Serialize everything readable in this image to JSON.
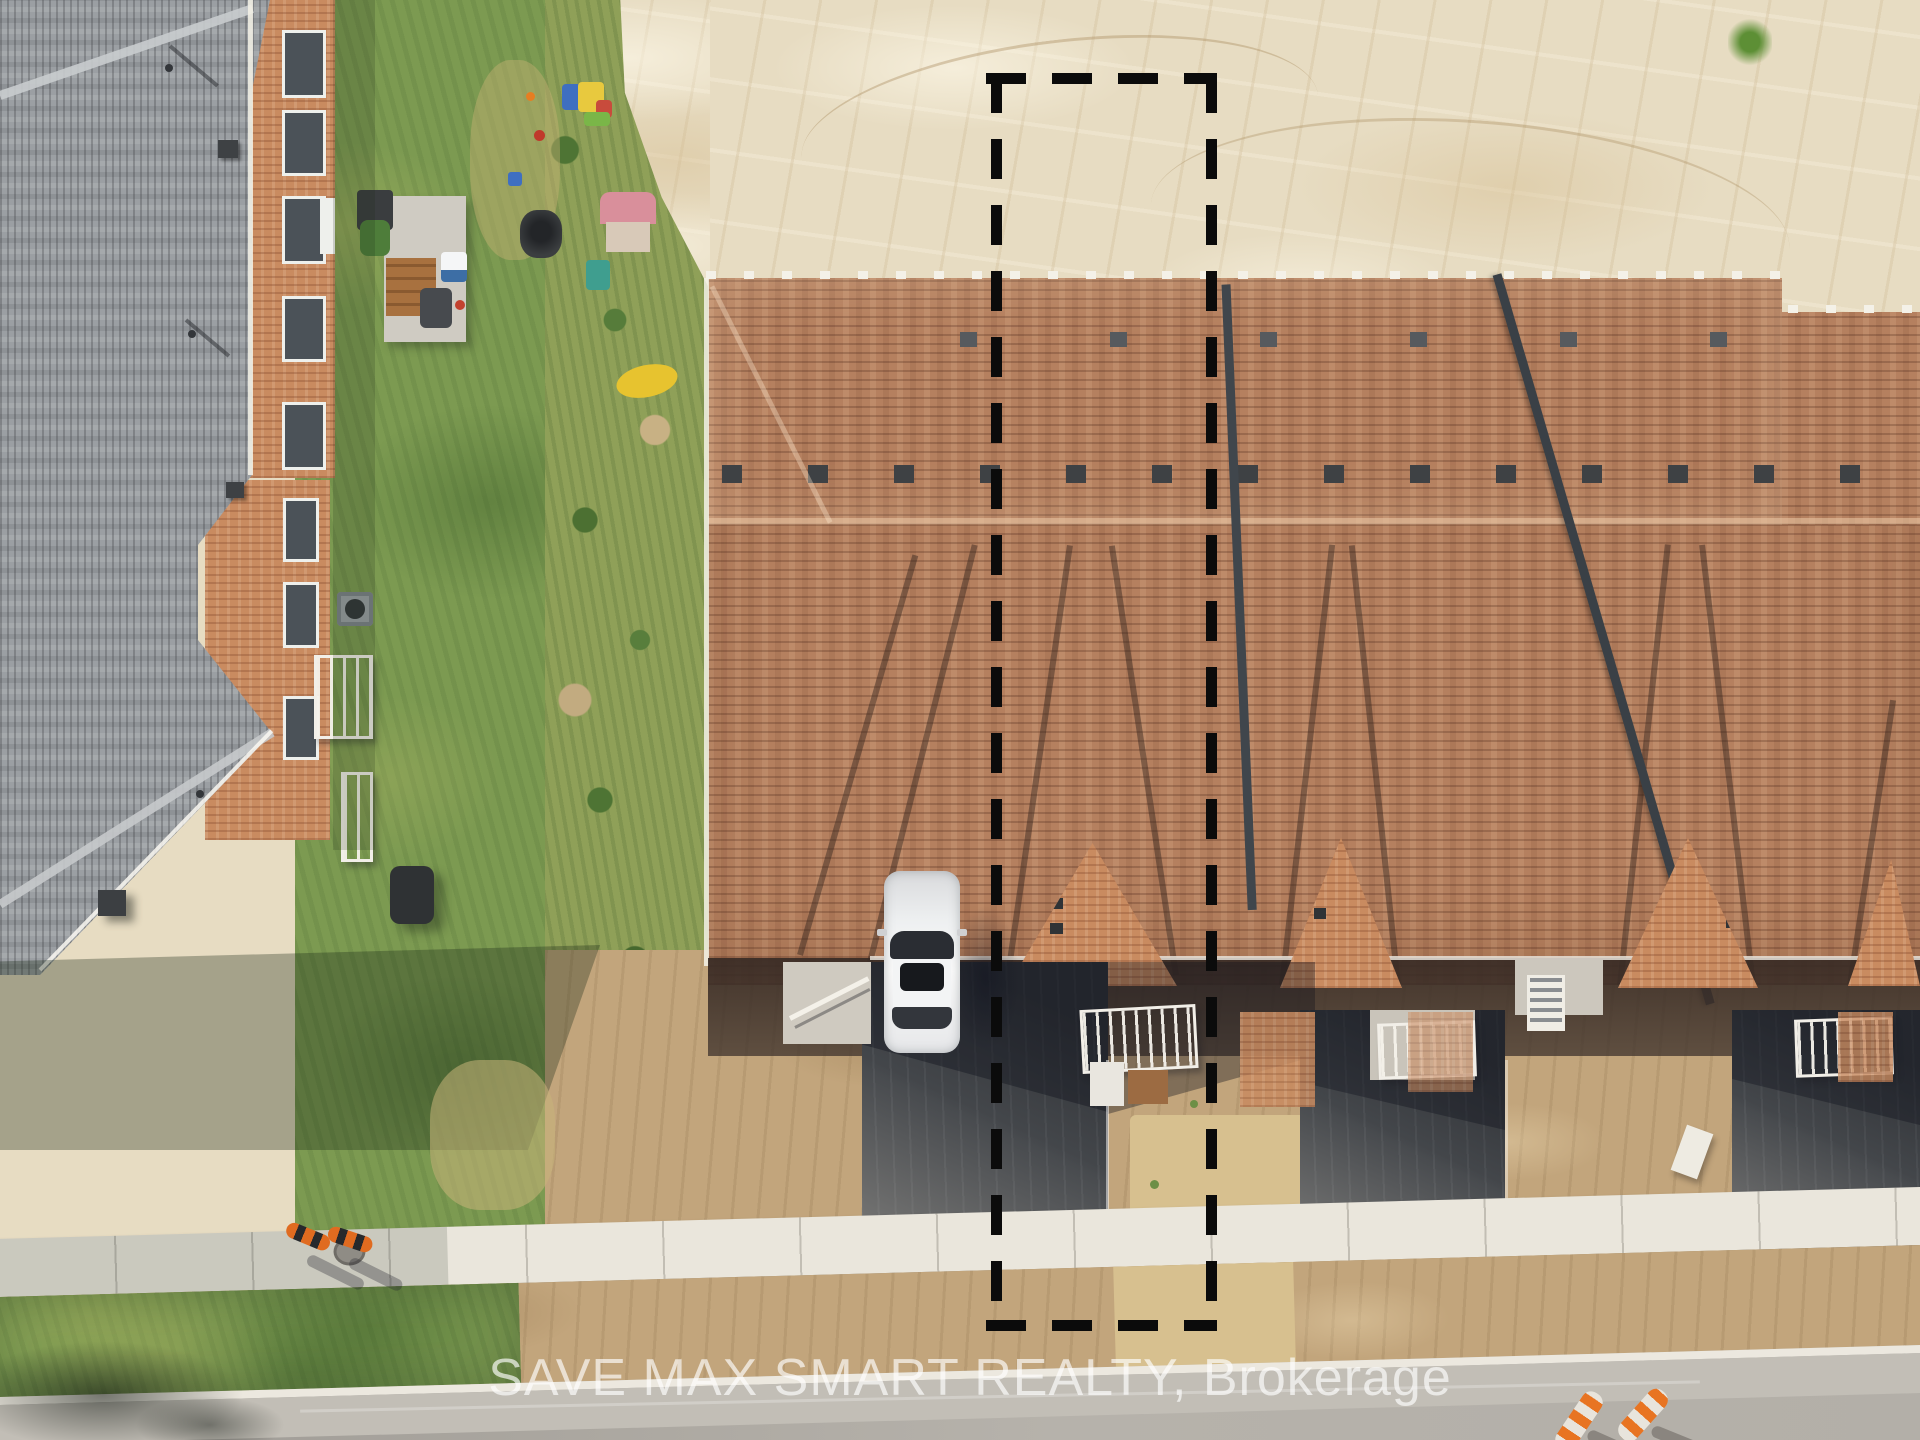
{
  "image_type": "aerial-drone-photo-of-new-townhouse-construction",
  "watermark": {
    "text": "SAVE MAX SMART REALTY, Brokerage"
  },
  "property_boundary": {
    "style": "dashed",
    "color": "#0b0b0b"
  },
  "objects": [
    {
      "name": "grey-roof-house",
      "color": "#9b9fa3"
    },
    {
      "name": "brick-walls",
      "color": "#c98b60"
    },
    {
      "name": "backyard-lawn",
      "color": "#7c9a51"
    },
    {
      "name": "playground-toys",
      "colors": [
        "#3f6fc1",
        "#e8c93e",
        "#c84b3c",
        "#d98f9b",
        "#3f9e8f"
      ]
    },
    {
      "name": "sand-lot",
      "color": "#e7dcc2"
    },
    {
      "name": "brown-shingle-townhouse-roof",
      "color": "#b5805f"
    },
    {
      "name": "white-car",
      "color": "#f2f3f4"
    },
    {
      "name": "asphalt-driveways",
      "color": "#45484c"
    },
    {
      "name": "dirt-driveway",
      "color": "#c2a57c"
    },
    {
      "name": "sidewalk",
      "color": "#eae6dc"
    },
    {
      "name": "road",
      "color": "#b3afa8"
    },
    {
      "name": "traffic-cones",
      "color": "#e06b20"
    },
    {
      "name": "orange-marker-posts",
      "color": "#e87422"
    }
  ],
  "colors": {
    "sand": "#e7dcc2",
    "lawn": "#7c9a51",
    "weeds": "#8fa058",
    "roofBrown": "#b5805f",
    "roofGrey": "#9b9fa3",
    "brick": "#c98b60",
    "asphalt": "#45484c",
    "dirt": "#c2a57c",
    "dirtLight": "#d7c08f",
    "sidewalk": "#eae6dc",
    "road": "#b3afa8",
    "dash": "#0b0b0b",
    "cone": "#e06b20",
    "watermark": "rgba(255,255,255,0.66)"
  }
}
